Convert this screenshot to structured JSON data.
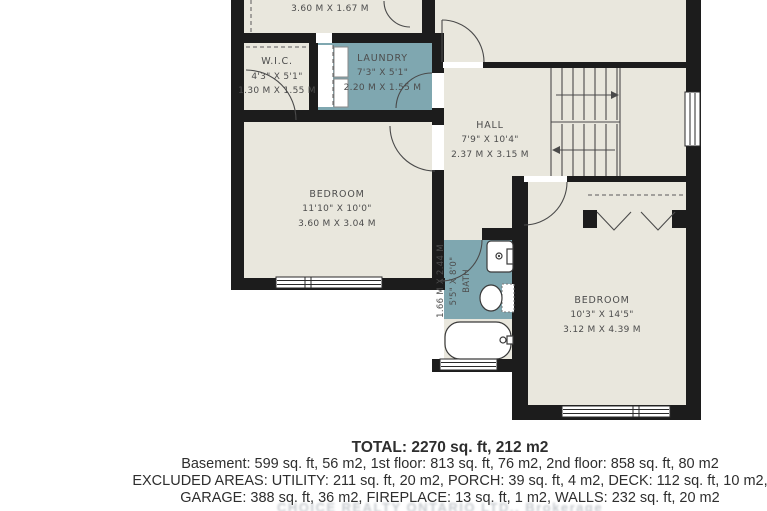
{
  "plan": {
    "rooms": {
      "top_room": {
        "metric": "3.60 M X 1.67 M"
      },
      "wic": {
        "name": "W.I.C.",
        "imperial": "4'3\" X 5'1\"",
        "metric": "1.30 M X 1.55 M"
      },
      "laundry": {
        "name": "LAUNDRY",
        "imperial": "7'3\" X 5'1\"",
        "metric": "2.20 M X 1.55 M"
      },
      "hall": {
        "name": "HALL",
        "imperial": "7'9\" X 10'4\"",
        "metric": "2.37 M X 3.15 M"
      },
      "bedroom_left": {
        "name": "BEDROOM",
        "imperial": "11'10\" X 10'0\"",
        "metric": "3.60 M X 3.04 M"
      },
      "bath": {
        "name": "BATH",
        "imperial": "5'5\" X 8'0\"",
        "metric": "1.66 M X 2.44 M"
      },
      "bedroom_right": {
        "name": "BEDROOM",
        "imperial": "10'3\" X 14'5\"",
        "metric": "3.12 M X 4.39 M"
      }
    },
    "colors": {
      "wall": "#1c1c1c",
      "floor": "#e9e7dd",
      "wet_floor": "#7fa7b0",
      "label": "#4d4d4d"
    }
  },
  "summary": {
    "total": "TOTAL: 2270 sq. ft, 212 m2",
    "floors": "Basement: 599 sq. ft, 56 m2, 1st floor: 813 sq. ft, 76 m2, 2nd floor: 858 sq. ft, 80 m2",
    "excluded": "EXCLUDED AREAS: UTILITY: 211 sq. ft, 20 m2, PORCH: 39 sq. ft, 4 m2, DECK: 112 sq. ft, 10 m2,",
    "excluded2": "GARAGE: 388 sq. ft, 36 m2, FIREPLACE: 13 sq. ft, 1 m2, WALLS: 232 sq. ft, 20 m2"
  },
  "watermark": "CHOICE REALTY ONTARIO LTD., Brokerage"
}
